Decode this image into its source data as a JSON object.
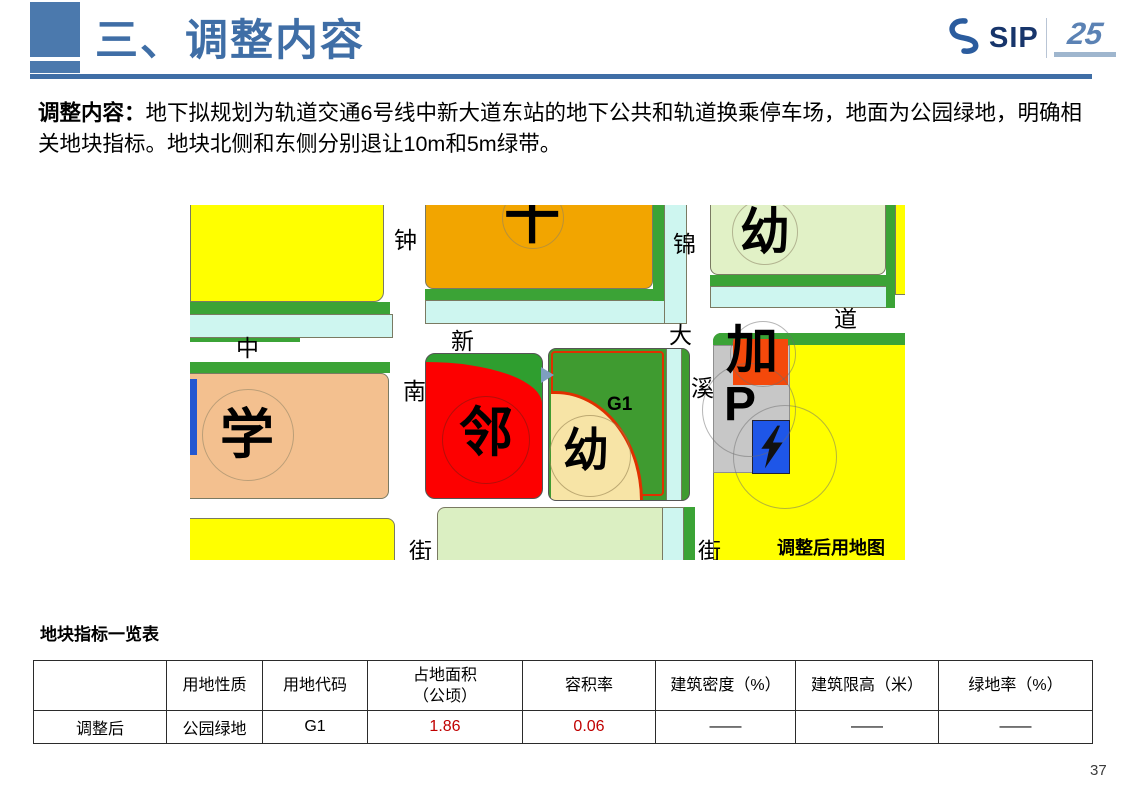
{
  "slide": {
    "title": "三、调整内容",
    "page_number": "37"
  },
  "logo": {
    "sip": "SIP",
    "anniversary": "25"
  },
  "description": {
    "label": "调整内容：",
    "text": "地下拟规划为轨道交通6号线中新大道东站的地下公共和轨道换乘停车场，地面为公园绿地，明确相关地块指标。地块北侧和东侧分别退让10m和5m绿带。"
  },
  "map": {
    "caption": "调整后用地图",
    "road_labels": {
      "zhong_s": "钟",
      "jin": "锦",
      "zhong_x": "中",
      "xin": "新",
      "da": "大",
      "dao": "道",
      "nan": "南",
      "xi": "溪",
      "jie_w": "街",
      "jie_e": "街"
    },
    "block_labels": {
      "hospital_cross": "十",
      "kindergarten_ne": "幼",
      "school": "学",
      "neighborhood": "邻",
      "kindergarten_sw": "幼",
      "plot_code": "G1",
      "gas": "加",
      "parking": "P"
    },
    "colors": {
      "yellow": "#ffff00",
      "orange": "#f2a500",
      "light_green": "#e1f1c6",
      "strip_green": "#3ba336",
      "canal_cyan": "#cef6f0",
      "red_block": "#fd0000",
      "peach": "#f3c08f",
      "gray": "#c7c7c7",
      "plot_green": "#3f9b30",
      "tan": "#f7e4a6",
      "plot_outline_red": "#e03000",
      "charge_blue": "#1e56e8"
    }
  },
  "table": {
    "title": "地块指标一览表",
    "headers": [
      "",
      "用地性质",
      "用地代码",
      "占地面积\n（公顷）",
      "容积率",
      "建筑密度（%）",
      "建筑限高（米）",
      "绿地率（%）"
    ],
    "rows": [
      [
        "调整后",
        "公园绿地",
        "G1",
        "1.86",
        "0.06",
        "——",
        "——",
        "——"
      ]
    ]
  }
}
